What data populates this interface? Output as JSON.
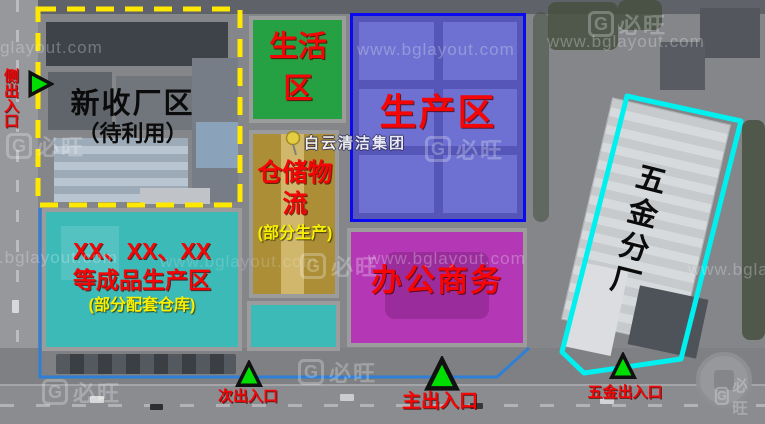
{
  "watermark": {
    "url": "www.bglayout.com",
    "logo_letter": "G",
    "logo_text": "必旺"
  },
  "poi": {
    "label": "白云清洁集团"
  },
  "zones": {
    "new_factory": {
      "label": "新收厂区",
      "sublabel": "（待利用）",
      "outline_color": "#ffe800",
      "outline_style": "dashed"
    },
    "living": {
      "label": "生活区",
      "fill_color": "#18a438"
    },
    "warehouse": {
      "label": "仓储物流",
      "sublabel": "(部分生产)",
      "fill_color": "#b0902a"
    },
    "production": {
      "label": "生产区",
      "fill_color": "#3434d7",
      "outline_color": "#0a0af0"
    },
    "finished": {
      "label_line1": "XX、XX、XX",
      "label_line2": "等成品生产区",
      "sublabel": "(部分配套仓库)",
      "fill_color": "#2cc6c2"
    },
    "office": {
      "label": "办公商务",
      "fill_color": "#bb2dbb"
    },
    "hardware": {
      "label": "五金分厂",
      "outline_color": "#00f0f0"
    }
  },
  "entrances": {
    "side": {
      "label": "侧出入口"
    },
    "secondary": {
      "label": "次出入口"
    },
    "main": {
      "label": "主出入口"
    },
    "hardware": {
      "label": "五金出入口"
    }
  },
  "colors": {
    "label_red": "#f50505",
    "label_yellow": "#f8f000",
    "label_black": "#0b0b0b",
    "entrance_green": "#00dd00",
    "boundary_blue": "#2f7fd6",
    "zone_border_gray": "#9c9c9c"
  }
}
